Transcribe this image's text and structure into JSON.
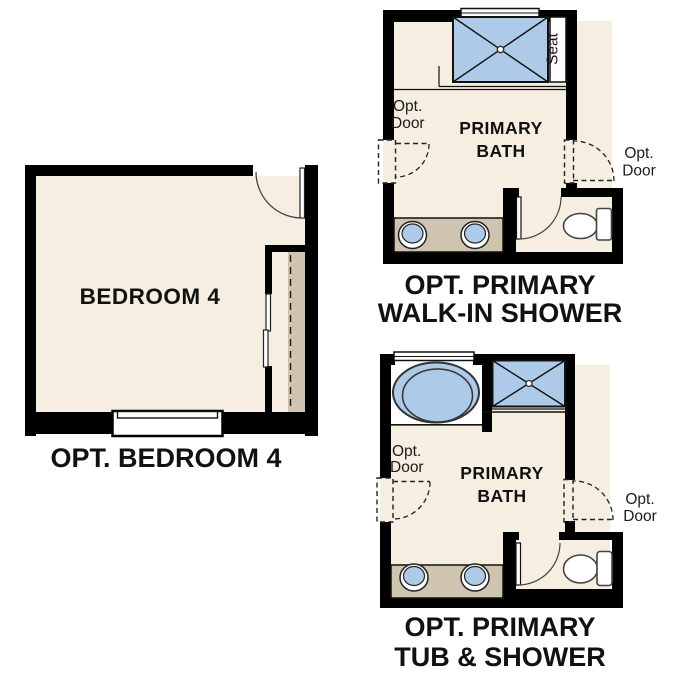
{
  "colors": {
    "background": "#ffffff",
    "wall": "#000000",
    "floor": "#f5eee1",
    "fixture_blue": "#adcae8",
    "counter_tan": "#cfc4b0",
    "text": "#111111"
  },
  "bedroom_plan": {
    "room_label": "BEDROOM 4",
    "caption": "OPT. BEDROOM 4"
  },
  "walk_in_shower_plan": {
    "room_label_line1": "PRIMARY",
    "room_label_line2": "BATH",
    "seat_label": "Seat",
    "left_opt_door_line1": "Opt.",
    "left_opt_door_line2": "Door",
    "right_opt_door_line1": "Opt.",
    "right_opt_door_line2": "Door",
    "caption_line1": "OPT. PRIMARY",
    "caption_line2": "WALK-IN SHOWER"
  },
  "tub_shower_plan": {
    "room_label_line1": "PRIMARY",
    "room_label_line2": "BATH",
    "left_opt_door_line1": "Opt.",
    "left_opt_door_line2": "Door",
    "right_opt_door_line1": "Opt.",
    "right_opt_door_line2": "Door",
    "caption_line1": "OPT. PRIMARY",
    "caption_line2": "TUB & SHOWER"
  }
}
